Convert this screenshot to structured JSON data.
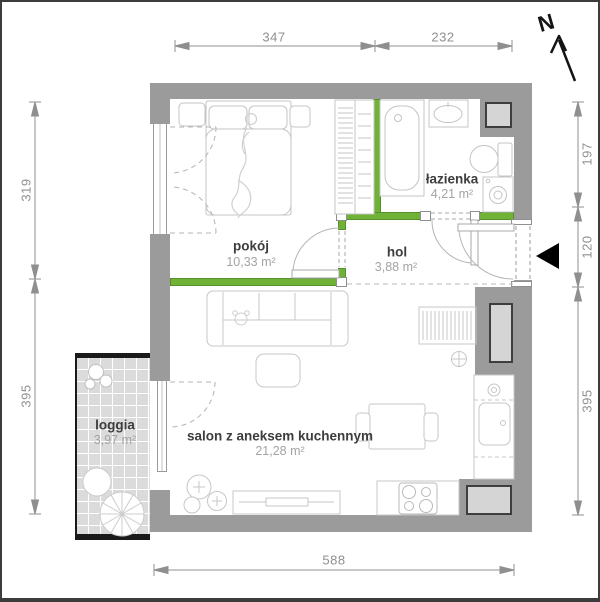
{
  "north": {
    "label": "N"
  },
  "rooms": {
    "pokoj": {
      "name": "pokój",
      "area": "10,33 m²"
    },
    "lazienka": {
      "name": "łazienka",
      "area": "4,21 m²"
    },
    "hol": {
      "name": "hol",
      "area": "3,88 m²"
    },
    "salon": {
      "name": "salon z aneksem kuchennym",
      "area": "21,28 m²"
    },
    "loggia": {
      "name": "loggia",
      "area": "3,97 m²"
    }
  },
  "dimensions_cm": {
    "top_left_segment": "347",
    "top_right_segment": "232",
    "left_upper": "319",
    "left_lower": "395",
    "right_upper": "197",
    "right_entrance": "120",
    "right_lower": "395",
    "bottom": "588"
  },
  "furniture_icons": [
    "bed",
    "wardrobe",
    "bathtub",
    "washbasin",
    "toilet",
    "washing-machine",
    "sofa",
    "teddy-bear",
    "coffee-table",
    "tv-stand",
    "plant",
    "dining-table",
    "chairs",
    "kitchen-sink",
    "stove",
    "radiator",
    "round-table",
    "garden-chair"
  ],
  "colors": {
    "wall_gray": "#9b9b9b",
    "partition_green": "#6fb236",
    "shaft_fill": "#d5d5d5",
    "loggia_tile": "#dbdbdb",
    "dimension_gray": "#8f8f8f",
    "room_name": "#3d3d3d",
    "room_area": "#a3a3a3",
    "entrance_marker": "#000000"
  }
}
